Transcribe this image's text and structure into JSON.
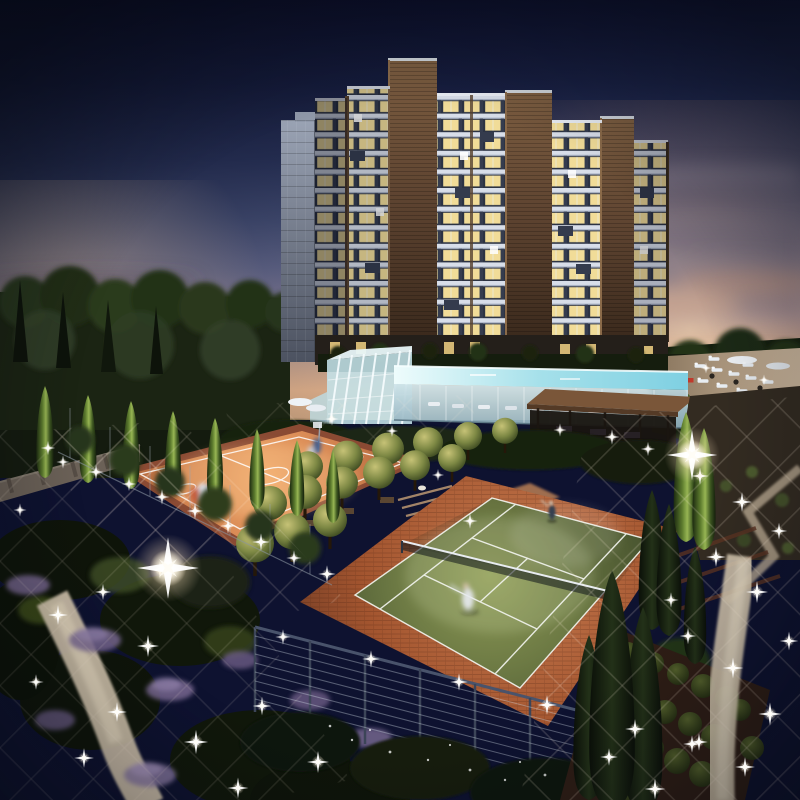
{
  "meta": {
    "description": "Dusk architectural rendering of a residential complex: a stepped high-rise apartment tower with warmly lit balconies, a grey service slab, an elevated glowing infinity pool with glass winter-garden and timber pergola, a floodlit clay basketball court with players, a grass tennis court with two players, orchard trees, cypress rows, cable fences with sparkling lights and winding illuminated garden paths."
  },
  "colors": {
    "sky_top": "#0e1230",
    "sky_mid": "#4a557e",
    "sky_horizon": "#e2b28c",
    "sunset_glow": "#ffd9a8",
    "facade_band": "#d8dee9",
    "window_lit": "#f1dc98",
    "window_dark": "#2c3343",
    "brick_pier": "#56402c",
    "core_brown": "#5d4330",
    "slab_gray": "#6a7180",
    "pool_water": "#a5e0ea",
    "glass_house": "#cfe7ec",
    "court_clay": "#cf7f4d",
    "court_lines": "#f2f4ee",
    "tennis_grass": "#6d7a44",
    "tennis_apron": "#a3552f",
    "cypress_lit": "#97b553",
    "cypress_dark": "#1d2a14",
    "orchard_tree": "#7d8844",
    "path_light": "#d5c7af",
    "lavender": "#7b6a94",
    "sparkle": "#ffffff",
    "hedge_dark": "#10160b",
    "pergola_wood": "#7a5639",
    "flag_red": "#c0392b"
  },
  "scene": {
    "building": {
      "floors": 14,
      "sections": 8,
      "cores": 3,
      "windows_state": "mostly lit"
    },
    "sparkles": [
      [
        63,
        462,
        0.6
      ],
      [
        96,
        472,
        0.7
      ],
      [
        129,
        484,
        0.65
      ],
      [
        162,
        497,
        0.7
      ],
      [
        195,
        511,
        0.75
      ],
      [
        228,
        526,
        0.7
      ],
      [
        261,
        542,
        0.8
      ],
      [
        294,
        558,
        0.7
      ],
      [
        327,
        574,
        0.8
      ],
      [
        58,
        615,
        0.9
      ],
      [
        103,
        592,
        0.75
      ],
      [
        148,
        646,
        1.0
      ],
      [
        117,
        712,
        0.9
      ],
      [
        196,
        742,
        1.1
      ],
      [
        262,
        706,
        0.85
      ],
      [
        318,
        762,
        1.0
      ],
      [
        36,
        682,
        0.7
      ],
      [
        84,
        758,
        0.9
      ],
      [
        238,
        788,
        0.95
      ],
      [
        160,
        570,
        0.8
      ],
      [
        283,
        637,
        0.7
      ],
      [
        371,
        659,
        0.8
      ],
      [
        459,
        682,
        0.8
      ],
      [
        547,
        705,
        0.9
      ],
      [
        635,
        729,
        0.9
      ],
      [
        692,
        744,
        0.8
      ],
      [
        700,
        476,
        0.8
      ],
      [
        742,
        502,
        0.9
      ],
      [
        779,
        531,
        0.75
      ],
      [
        716,
        557,
        0.9
      ],
      [
        757,
        592,
        1.0
      ],
      [
        789,
        641,
        0.85
      ],
      [
        733,
        668,
        0.95
      ],
      [
        770,
        714,
        1.05
      ],
      [
        745,
        767,
        0.9
      ],
      [
        699,
        742,
        0.8
      ],
      [
        655,
        789,
        0.95
      ],
      [
        609,
        757,
        0.8
      ],
      [
        671,
        600,
        0.7
      ],
      [
        688,
        636,
        0.75
      ],
      [
        612,
        437,
        0.7
      ],
      [
        648,
        449,
        0.65
      ],
      [
        560,
        430,
        0.6
      ],
      [
        332,
        419,
        0.6
      ],
      [
        392,
        431,
        0.55
      ],
      [
        470,
        521,
        0.7
      ],
      [
        438,
        475,
        0.55
      ],
      [
        48,
        448,
        0.65
      ],
      [
        20,
        510,
        0.6
      ],
      [
        706,
        368,
        0.5
      ],
      [
        764,
        380,
        0.5
      ]
    ],
    "flares": [
      [
        168,
        568,
        2.8
      ],
      [
        692,
        455,
        2.3
      ]
    ],
    "cypresses_lit_left": [
      [
        45,
        478,
        92
      ],
      [
        88,
        483,
        88
      ],
      [
        131,
        489,
        88
      ],
      [
        173,
        495,
        84
      ],
      [
        215,
        502,
        84
      ],
      [
        257,
        509,
        80
      ],
      [
        297,
        516,
        76
      ],
      [
        333,
        523,
        72
      ]
    ],
    "cypresses_lit_right": [
      [
        686,
        542,
        130
      ],
      [
        704,
        550,
        122
      ]
    ],
    "cypresses_dark_right": [
      [
        652,
        630,
        140
      ],
      [
        669,
        636,
        132
      ],
      [
        695,
        664,
        118
      ],
      [
        589,
        800,
        165
      ],
      [
        643,
        812,
        205
      ],
      [
        612,
        810,
        240
      ]
    ],
    "orchard_trees": [
      [
        308,
        492,
        15
      ],
      [
        347,
        484,
        16
      ],
      [
        388,
        476,
        16
      ],
      [
        428,
        468,
        15
      ],
      [
        468,
        460,
        14
      ],
      [
        505,
        453,
        13
      ],
      [
        270,
        532,
        17
      ],
      [
        305,
        521,
        17
      ],
      [
        342,
        510,
        16
      ],
      [
        379,
        500,
        16
      ],
      [
        415,
        491,
        15
      ],
      [
        452,
        482,
        14
      ],
      [
        255,
        576,
        19
      ],
      [
        292,
        562,
        18
      ],
      [
        330,
        549,
        17
      ]
    ],
    "shrub_balls": [
      [
        628,
        652,
        10
      ],
      [
        653,
        663,
        11
      ],
      [
        678,
        674,
        11
      ],
      [
        703,
        686,
        12
      ],
      [
        727,
        698,
        12
      ],
      [
        641,
        700,
        11
      ],
      [
        665,
        712,
        12
      ],
      [
        690,
        724,
        12
      ],
      [
        714,
        737,
        13
      ],
      [
        652,
        748,
        12
      ],
      [
        677,
        761,
        13
      ],
      [
        702,
        774,
        13
      ],
      [
        627,
        792,
        12
      ],
      [
        740,
        710,
        11
      ],
      [
        752,
        748,
        12
      ]
    ],
    "pool_loungers": [
      [
        700,
        366
      ],
      [
        717,
        370
      ],
      [
        734,
        374
      ],
      [
        751,
        378
      ],
      [
        768,
        382
      ],
      [
        703,
        381
      ],
      [
        722,
        386
      ],
      [
        742,
        391
      ],
      [
        714,
        359
      ],
      [
        748,
        365
      ]
    ],
    "players": {
      "basketball": 4,
      "tennis": 2
    }
  }
}
